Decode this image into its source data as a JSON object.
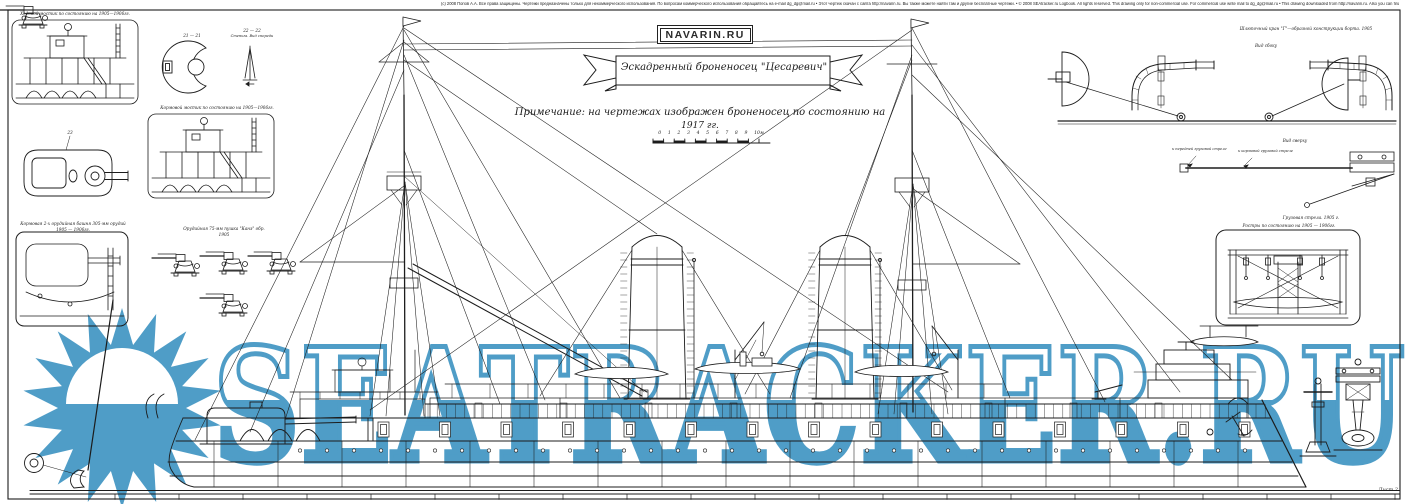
{
  "colors": {
    "watermark_blue": "#4f9dc7",
    "ink": "#1c1c1c",
    "paper": "#ffffff"
  },
  "watermark": {
    "text": "SEATRACKER.RU"
  },
  "header": {
    "copyright_line": "(c) 2008 Попов А.А. Все права защищены. Чертежи предназначены только для некоммерческого использования. По вопросам коммерческого использования обращайтесь на e-mail dg_dg@mail.ru • Этот чертеж скачан с сайта http://navarin.ru. Вы также можете найти там и другие бесплатные чертежи. • © 2008 SEAtracker.ru Logbook. All rights reserved. This drawing only for non-commercial use. For commercial use write mail to dg_dg@mail.ru • This drawing downloaded from http://navarin.ru. Also you can find there a lot of free drawings.",
    "site_badge": "NAVARIN.RU",
    "title_banner": "Эскадренный броненосец \"Цесаревич\"",
    "note_line1": "Примечание: на чертежах изображен броненосец по состоянию на",
    "note_line2": "1917 гг.",
    "scale_numbers": "0 1 2 3 4 5 6 7 8 9 10",
    "scale_unit": "м"
  },
  "details": {
    "bridge_fore_caption": "Ходовой мостик по состоянию на 1905—1906гг.",
    "bridge_aft_caption": "Кормовой мостик по состоянию на 1905—1906гг.",
    "section_a_label": "21 — 21",
    "section_b_label": "22 — 22",
    "section_b_caption": "Стеньга. Вид спереди",
    "turret_plan_label": "23",
    "turret_box_caption_1": "Кормовая 2-х орудийная башня 305-мм орудий",
    "turret_box_caption_2": "1905 — 1906гг.",
    "guns_caption_1": "Орудийная 75-мм пушка \"Канэ\" обр.",
    "guns_caption_2": "1905",
    "davits_caption": "Шлюпочный кран \"Г\"—образной конструкции борта. 1905",
    "davits_view_label": "Вид сбоку",
    "boom_view_label": "Вид сверху",
    "boom_label_1": "к передней грузовой стреле",
    "boom_label_2": "к кормовой грузовой стреле",
    "boom_caption": "Грузовая стрела. 1905 г.",
    "rostra_caption": "Ростры по состоянию на 1905 — 1906гг."
  },
  "sheet": {
    "label": "Лист 2"
  }
}
